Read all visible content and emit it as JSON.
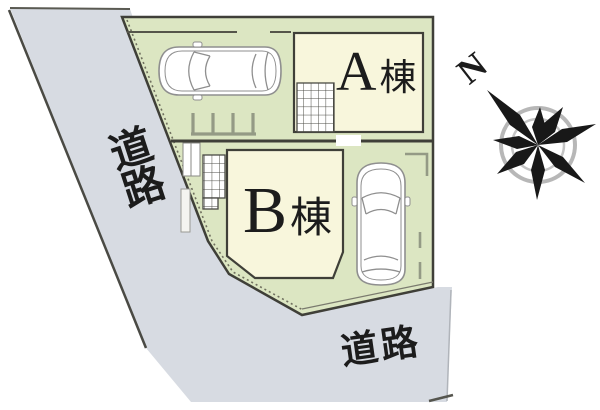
{
  "roads": {
    "left": {
      "label": "道路"
    },
    "bottom": {
      "label": "道路"
    }
  },
  "buildings": {
    "a": {
      "letter": "A",
      "suffix": "棟"
    },
    "b": {
      "letter": "B",
      "suffix": "棟"
    }
  },
  "compass": {
    "north_label": "N"
  },
  "icons": {
    "compass": "compass-rose-icon",
    "car": "car-top-view-icon",
    "entrance_tiles": "tile-grid-icon",
    "parking_stopper": "parking-stopper-icon"
  },
  "colors": {
    "road": "#d7dbe2",
    "plot": "#dce6c2",
    "building": "#f8f6dc",
    "border": "#3f3f38",
    "linegray": "#949a85",
    "carline": "#8f8f8f",
    "ring": "#b7b7b7",
    "star": "#181818",
    "tile": "#4a4a44",
    "text": "#1c1c1c"
  }
}
